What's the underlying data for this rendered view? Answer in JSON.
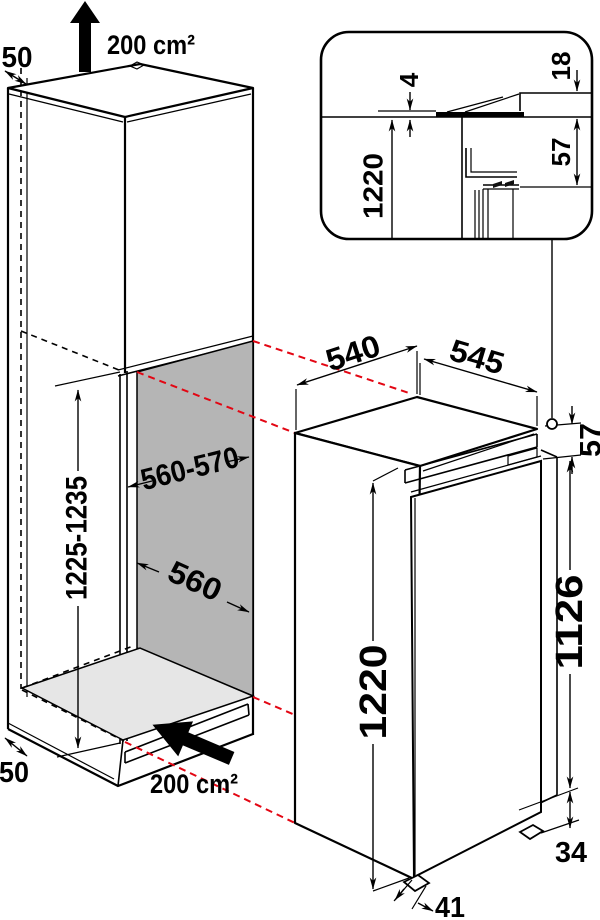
{
  "diagram": {
    "title": "Built-in refrigerator installation dimensions",
    "cabinet": {
      "top_clearance": "50",
      "top_vent": "200 cm²",
      "niche_height": "1225-1235",
      "niche_width": "560-570",
      "niche_depth": "560",
      "bottom_clearance": "50",
      "bottom_vent": "200 cm²"
    },
    "appliance": {
      "width": "540",
      "depth": "545",
      "top_gap": "57",
      "height": "1220",
      "door_height": "1126",
      "plinth_height": "34",
      "foot_inset": "41"
    },
    "detail_inset": {
      "seal_gap": "4",
      "worktop_thickness": "18",
      "top_clearance": "57",
      "appliance_height": "1220"
    },
    "colors": {
      "projection_red": "#e30613",
      "niche_back": "#b5b5b5",
      "niche_floor": "#e6e6e6",
      "line": "#000000"
    }
  }
}
